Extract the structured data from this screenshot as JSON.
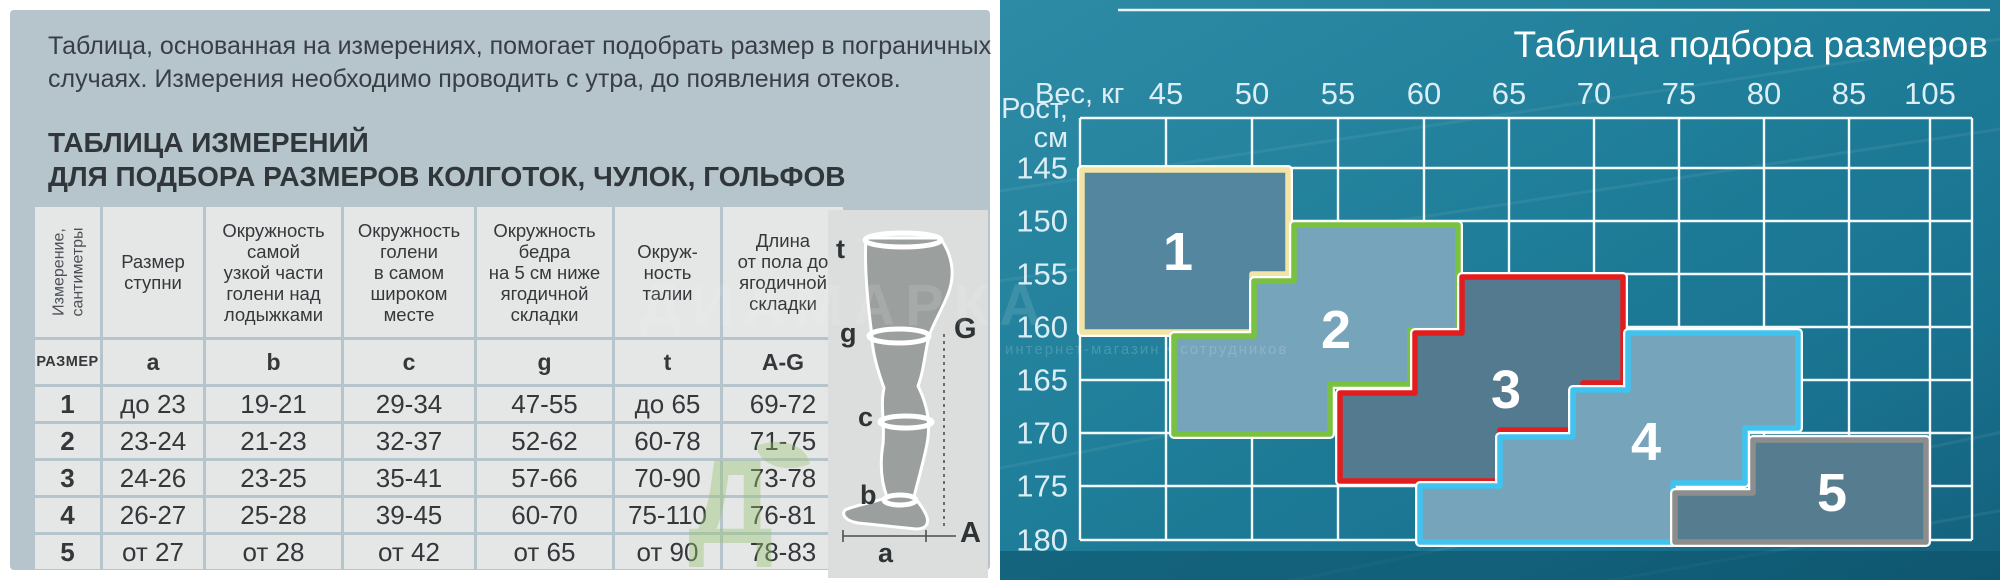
{
  "left_panel": {
    "intro": "Таблица, основанная на измерениях, помогает подобрать размер в пограничных\nслучаях. Измерения необходимо проводить с утра, до появления отеков.",
    "heading": "ТАБЛИЦА ИЗМЕРЕНИЙ\nДЛЯ ПОДБОРА РАЗМЕРОВ КОЛГОТОК, ЧУЛОК, ГОЛЬФОВ",
    "table": {
      "corner_header": "Измерение,\nсантиметры",
      "headers": [
        "Размер\nступни",
        "Окружность\nсамой\nузкой части\nголени над\nлодыжками",
        "Окружность\nголени\nв самом\nшироком\nместе",
        "Окружность\nбедра\nна 5 см ниже\nягодичной\nскладки",
        "Окруж-\nность\nталии",
        "Длина\nот пола до\nягодичной\nскладки"
      ],
      "subheader": [
        "РАЗМЕР",
        "a",
        "b",
        "c",
        "g",
        "t",
        "A-G"
      ],
      "rows": [
        [
          "1",
          "до 23",
          "19-21",
          "29-34",
          "47-55",
          "до 65",
          "69-72"
        ],
        [
          "2",
          "23-24",
          "21-23",
          "32-37",
          "52-62",
          "60-78",
          "71-75"
        ],
        [
          "3",
          "24-26",
          "23-25",
          "35-41",
          "57-66",
          "70-90",
          "73-78"
        ],
        [
          "4",
          "26-27",
          "25-28",
          "39-45",
          "60-70",
          "75-110",
          "76-81"
        ],
        [
          "5",
          "от 27",
          "от 28",
          "от 42",
          "от 65",
          "от 90",
          "78-83"
        ]
      ]
    },
    "leg_diagram": {
      "labels": [
        {
          "id": "t",
          "x": 8,
          "y": 48,
          "size": 27
        },
        {
          "id": "g",
          "x": 12,
          "y": 132,
          "size": 27
        },
        {
          "id": "c",
          "x": 30,
          "y": 216,
          "size": 27
        },
        {
          "id": "b",
          "x": 32,
          "y": 294,
          "size": 27
        },
        {
          "id": "a",
          "x": 50,
          "y": 352,
          "size": 27
        },
        {
          "id": "G",
          "x": 126,
          "y": 128,
          "size": 29
        },
        {
          "id": "A",
          "x": 132,
          "y": 332,
          "size": 29
        }
      ]
    }
  },
  "watermark": {
    "brand": "ДИАМАРКА",
    "tagline": "интернет-магазин • сотрудников",
    "letter": "Д"
  },
  "chart": {
    "title": "Таблица подбора размеров",
    "x_label": "Вес, кг",
    "y_label_line1": "Рост,",
    "y_label_line2": "см"
  },
  "chart_data": {
    "type": "step-region-size-map",
    "title": "Таблица подбора размеров",
    "x_axis": {
      "label": "Вес, кг",
      "ticks": [
        45,
        50,
        55,
        60,
        65,
        70,
        75,
        80,
        85,
        105
      ]
    },
    "y_axis": {
      "label": "Рост, см",
      "ticks": [
        145,
        150,
        155,
        160,
        165,
        170,
        175,
        180
      ]
    },
    "grid": {
      "col_x": [
        80,
        166,
        252,
        338,
        424,
        509,
        594,
        679,
        764,
        849,
        930,
        972
      ],
      "row_y": [
        118,
        168,
        221,
        274,
        327,
        380,
        433,
        486,
        540
      ],
      "tick_baseline_y": 104,
      "ytick_right_x": 68
    },
    "regions": [
      {
        "size": "1",
        "border_color": "#f2e4a4",
        "fill_color": "#54869f",
        "approx_weight_kg": "до ~52",
        "approx_height_cm": "145–160",
        "label_x": 178,
        "label_y": 270,
        "polygon": [
          [
            82,
            170
          ],
          [
            288,
            170
          ],
          [
            288,
            274
          ],
          [
            252,
            274
          ],
          [
            252,
            332
          ],
          [
            82,
            332
          ]
        ]
      },
      {
        "size": "2",
        "border_color": "#79c23f",
        "fill_color": "#76a4ba",
        "approx_weight_kg": "~45–62",
        "approx_height_cm": "150–170",
        "label_x": 336,
        "label_y": 348,
        "polygon": [
          [
            294,
            225
          ],
          [
            458,
            225
          ],
          [
            458,
            330
          ],
          [
            410,
            330
          ],
          [
            410,
            384
          ],
          [
            330,
            384
          ],
          [
            330,
            434
          ],
          [
            174,
            434
          ],
          [
            174,
            336
          ],
          [
            254,
            336
          ],
          [
            254,
            281
          ],
          [
            294,
            281
          ]
        ]
      },
      {
        "size": "3",
        "border_color": "#e31d1d",
        "fill_color": "#537a8e",
        "approx_weight_kg": "~55–71",
        "approx_height_cm": "155–175",
        "label_x": 506,
        "label_y": 408,
        "polygon": [
          [
            462,
            277
          ],
          [
            623,
            277
          ],
          [
            623,
            383
          ],
          [
            583,
            383
          ],
          [
            583,
            430
          ],
          [
            500,
            430
          ],
          [
            500,
            481
          ],
          [
            340,
            481
          ],
          [
            340,
            393
          ],
          [
            415,
            393
          ],
          [
            415,
            333
          ],
          [
            462,
            333
          ]
        ]
      },
      {
        "size": "4",
        "border_color": "#40c4ef",
        "fill_color": "#76a4ba",
        "approx_weight_kg": "~63–83",
        "approx_height_cm": "160–180",
        "label_x": 646,
        "label_y": 460,
        "polygon": [
          [
            628,
            333
          ],
          [
            798,
            333
          ],
          [
            798,
            428
          ],
          [
            745,
            428
          ],
          [
            745,
            483
          ],
          [
            673,
            483
          ],
          [
            673,
            542
          ],
          [
            420,
            542
          ],
          [
            420,
            486
          ],
          [
            500,
            486
          ],
          [
            500,
            437
          ],
          [
            573,
            437
          ],
          [
            573,
            390
          ],
          [
            628,
            390
          ]
        ]
      },
      {
        "size": "5",
        "border_color": "#8d8d8d",
        "fill_color": "#567c90",
        "approx_weight_kg": "~70–105",
        "approx_height_cm": "170–180",
        "label_x": 832,
        "label_y": 511,
        "polygon": [
          [
            753,
            440
          ],
          [
            926,
            440
          ],
          [
            926,
            542
          ],
          [
            675,
            542
          ],
          [
            675,
            493
          ],
          [
            753,
            493
          ]
        ]
      }
    ]
  }
}
